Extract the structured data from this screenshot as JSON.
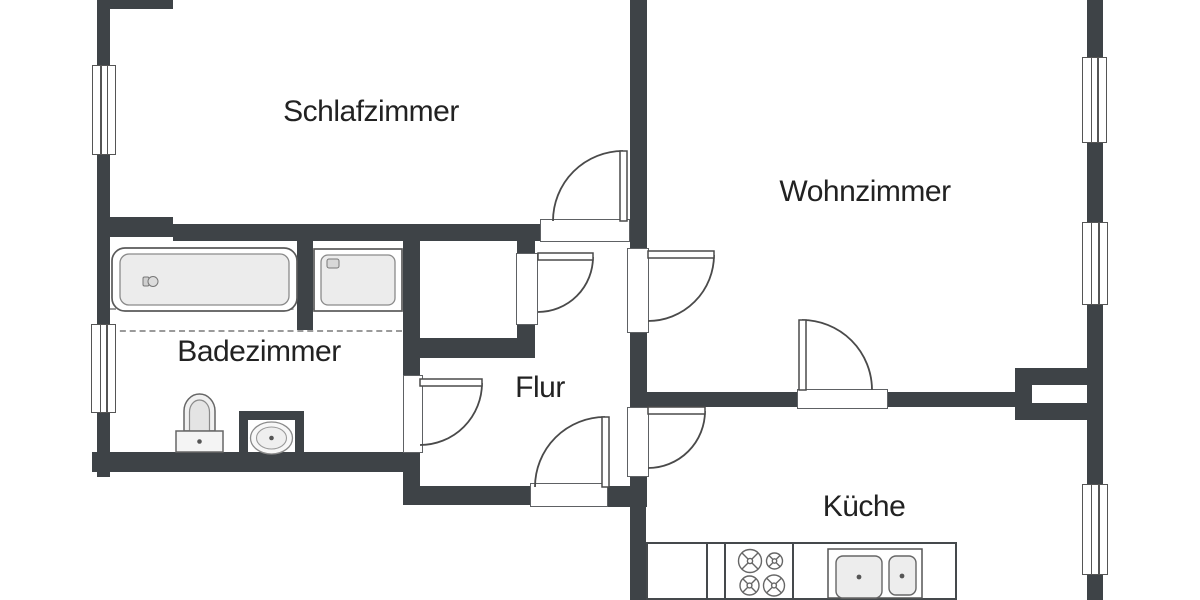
{
  "plan": {
    "type": "apartment-floor-plan",
    "language": "de",
    "rooms": {
      "schlafzimmer": {
        "label": "Schlafzimmer"
      },
      "wohnzimmer": {
        "label": "Wohnzimmer"
      },
      "badezimmer": {
        "label": "Badezimmer"
      },
      "flur": {
        "label": "Flur"
      },
      "kueche": {
        "label": "Küche"
      }
    },
    "fixtures": [
      "bathtub",
      "shower",
      "toilet",
      "washbasin",
      "stove-4-burners",
      "kitchen-double-sink"
    ],
    "features": {
      "doors": 7,
      "windows": 5,
      "closet": 1
    },
    "colors": {
      "wall": "#3e4347",
      "outline": "#4a4a4a",
      "fixture_fill": "#ececec",
      "text": "#222222",
      "background": "#ffffff"
    }
  }
}
